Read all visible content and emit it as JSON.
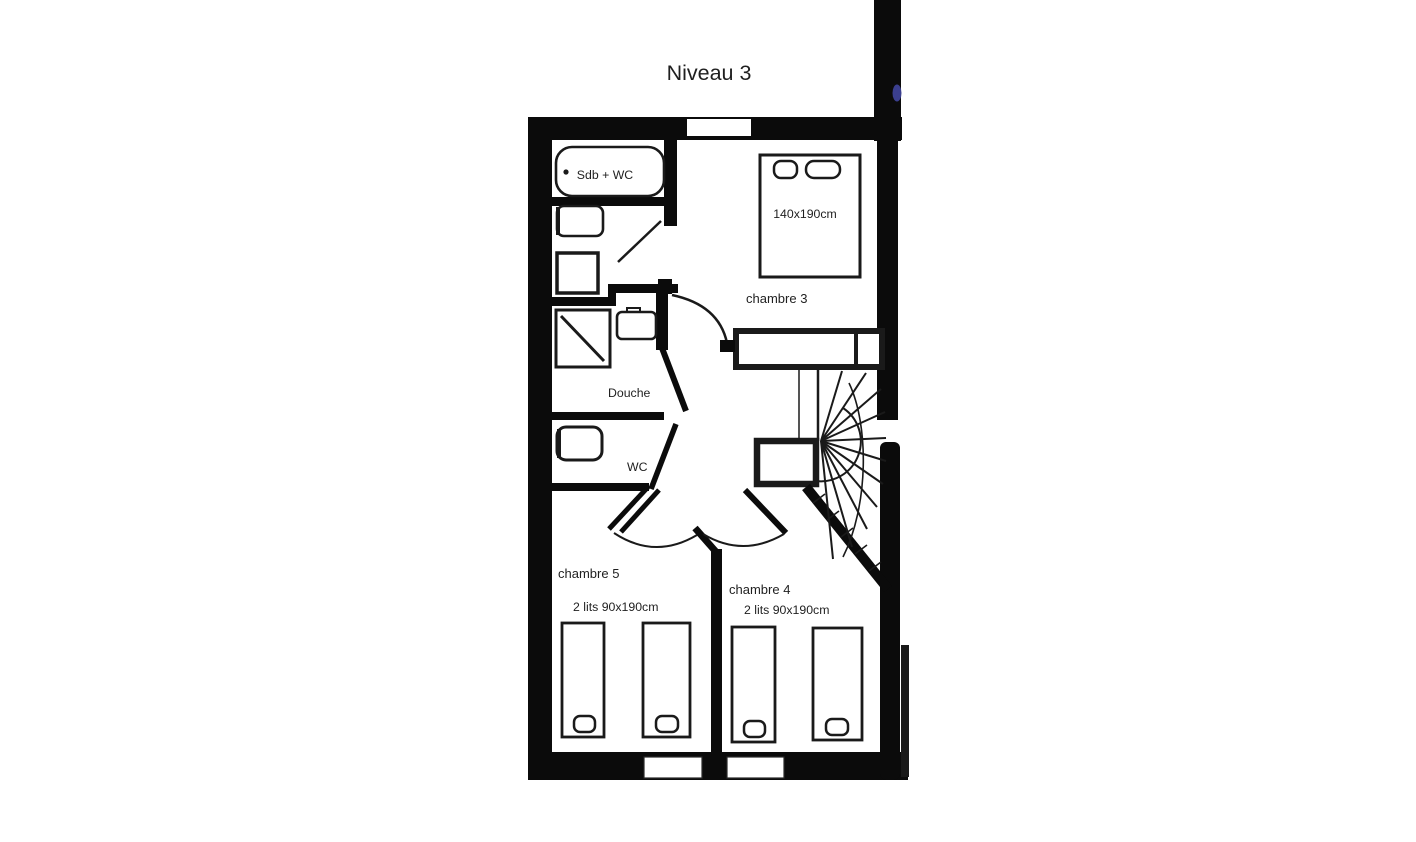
{
  "title": "Niveau 3",
  "colors": {
    "wall": "#0b0b0b",
    "line": "#1a1a1a",
    "text": "#1f1f1f",
    "accent_dot": "#3b3f8f",
    "background": "#ffffff"
  },
  "rooms": {
    "bathroom": {
      "label": "Sdb + WC"
    },
    "shower_room": {
      "label": "Douche"
    },
    "wc": {
      "label": "WC"
    },
    "bedroom3": {
      "label": "chambre 3",
      "bed_size": "140x190cm"
    },
    "bedroom5": {
      "label": "chambre 5",
      "beds": "2 lits 90x190cm"
    },
    "bedroom4": {
      "label": "chambre 4",
      "beds": "2 lits 90x190cm"
    }
  }
}
